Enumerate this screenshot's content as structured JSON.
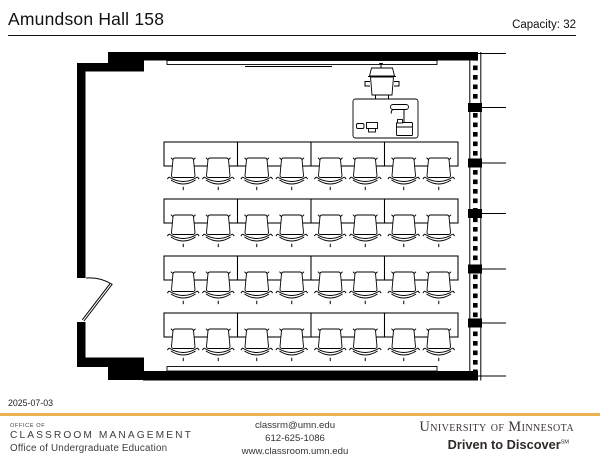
{
  "header": {
    "title": "Amundson Hall 158",
    "capacity_label": "Capacity: 32",
    "capacity_value": 32
  },
  "plan": {
    "seating": {
      "row_y": [
        142,
        199,
        256,
        313
      ],
      "table_x": 164,
      "table_w": 73.5,
      "table_h": 24,
      "tables_per_row": 4,
      "seats_per_table": 2,
      "seat_dx": 17.5,
      "seat_dy": 14.5,
      "total_seats": 32
    }
  },
  "footer": {
    "date": "2025-07-03",
    "office_small": "OFFICE OF",
    "office_name": "CLASSROOM MANAGEMENT",
    "office_sub": "Office of Undergraduate Education",
    "contact_email": "classrm@umn.edu",
    "contact_phone": "612-625-1086",
    "contact_web": "www.classroom.umn.edu",
    "university": "University of Minnesota",
    "tagline": "Driven to Discover",
    "tagline_mark": "SM"
  },
  "colors": {
    "accent_gold": "#E8B24E",
    "wall_black": "#000000"
  }
}
